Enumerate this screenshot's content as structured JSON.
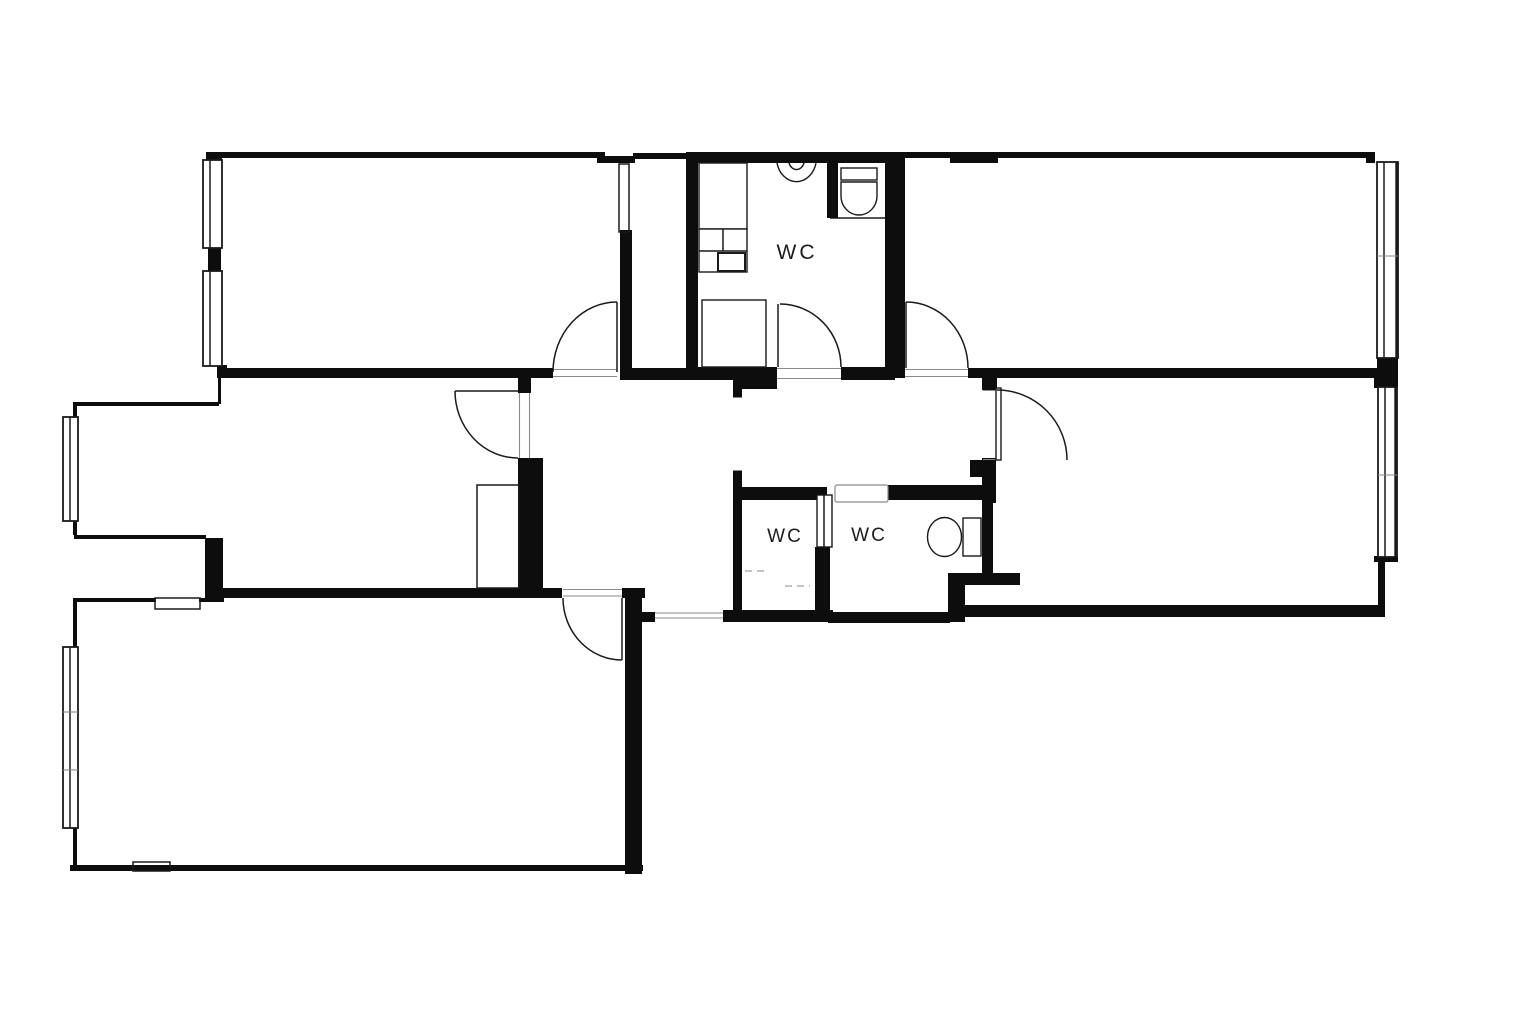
{
  "page": {
    "type": "architectural-floor-plan",
    "background": "#ffffff"
  },
  "labels": {
    "wc_top": "WC",
    "wc_mid_left": "WC",
    "wc_mid_right": "WC"
  },
  "colors": {
    "background": "#ffffff",
    "wall": "#0d0d0d",
    "line": "#1a1a1a",
    "light_line": "#8a8a8a",
    "text": "#1c1c1c"
  }
}
